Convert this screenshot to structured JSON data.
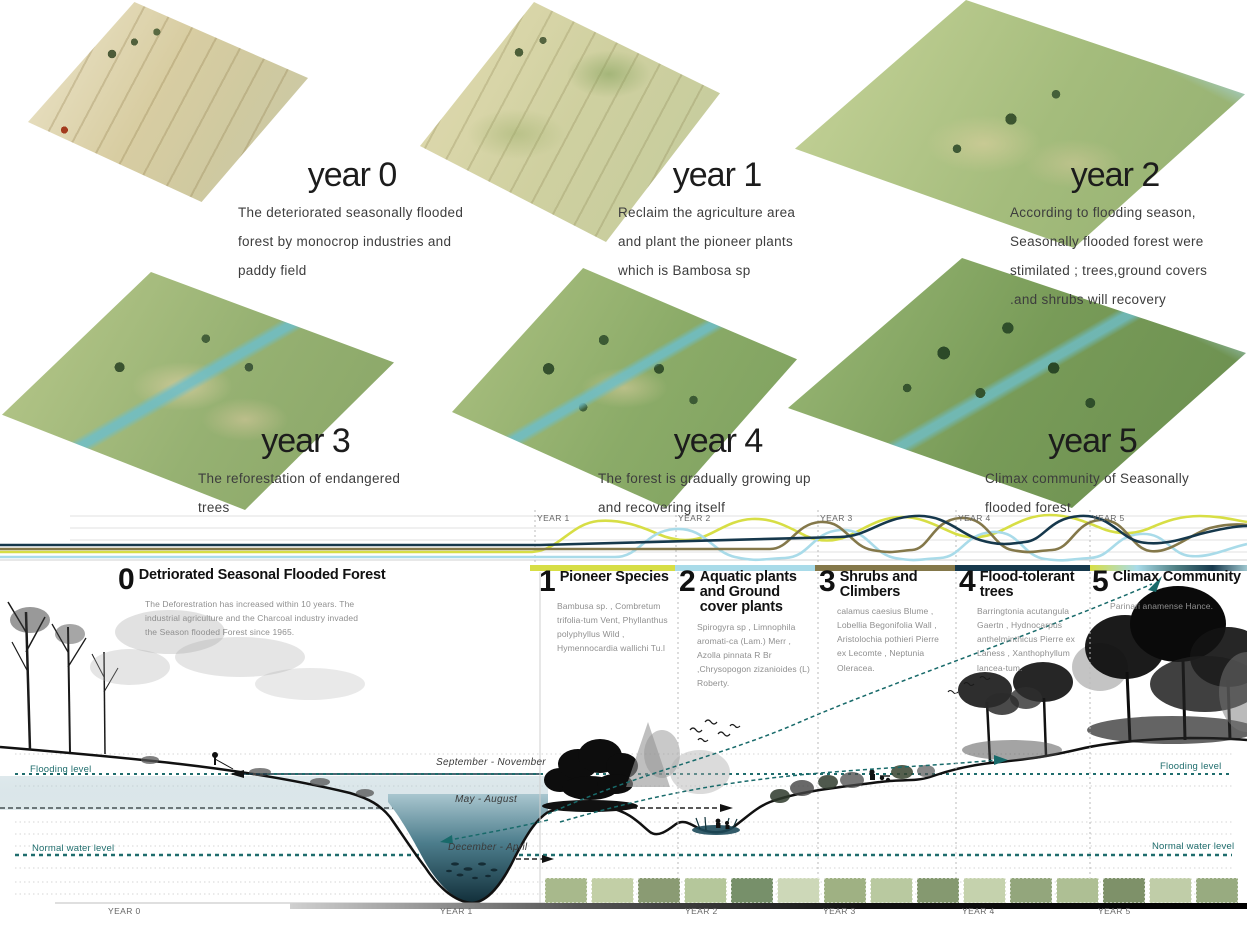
{
  "tiles": [
    {
      "title": "year 0",
      "body": "The deteriorated seasonally flooded forest by monocrop industries and paddy field"
    },
    {
      "title": "year 1",
      "body": "Reclaim the agriculture area and plant the pioneer plants which is Bambosa sp"
    },
    {
      "title": "year 2",
      "body": "According to flooding season, Seasonally flooded forest were stimilated ; trees,ground covers .and shrubs will recovery"
    },
    {
      "title": "year 3",
      "body": "The reforestation of endangered trees"
    },
    {
      "title": "year 4",
      "body": "The forest is gradually growing up and recovering itself"
    },
    {
      "title": "year 5",
      "body": "Climax community of Seasonally flooded forest"
    }
  ],
  "chart": {
    "top_axis_labels": [
      "YEAR 1",
      "YEAR 2",
      "YEAR 3",
      "YEAR 4",
      "YEAR 5"
    ],
    "bottom_axis_labels": [
      "YEAR 0",
      "YEAR 1",
      "YEAR 2",
      "YEAR 3",
      "YEAR 4",
      "YEAR 5"
    ]
  },
  "sections": [
    {
      "num": "0",
      "title": "Detriorated Seasonal Flooded Forest",
      "body": "The Deforestration has increased within 10 years. The industrial agriculture and the Charcoal industry invaded the Season flooded Forest since 1965."
    },
    {
      "num": "1",
      "title": "Pioneer Species",
      "body": "Bambusa sp. , Combretum trifolia-tum Vent, Phyllanthus polyphyllus Wild , Hymennocardia wallichi Tu.l"
    },
    {
      "num": "2",
      "title": "Aquatic plants and Ground cover plants",
      "body": "Spirogyra sp , Limnophila aromati-ca (Lam.) Merr , Azolla pinnata R Br ,Chrysopogon zizanioides (L) Roberty."
    },
    {
      "num": "3",
      "title": "Shrubs and Climbers",
      "body": "calamus caesius Blume , Lobellia Begonifolia Wall , Aristolochia pothieri Pierre ex Lecomte , Neptunia Oleracea."
    },
    {
      "num": "4",
      "title": "Flood-tolerant trees",
      "body": "Barringtonia acutangula Gaertn , Hydnocarpus anthelminthicus Pierre ex Laness , Xanthophyllum lancea-tum."
    },
    {
      "num": "5",
      "title": "Climax Community",
      "body": "Parinari anamense Hance."
    }
  ],
  "water_levels": {
    "flooding": "Flooding level",
    "normal": "Normal water level"
  },
  "seasons": [
    "September - November",
    "May - August",
    "December - April"
  ],
  "palette": {
    "curve_year1_pioneer": "#d7de45",
    "curve_year2_aquatic": "#a9dbe9",
    "curve_year3_shrubs": "#84784a",
    "curve_year4_trees": "#16384c",
    "water_label_teal": "#1f6d6d",
    "pond_dark": "#16384c"
  }
}
